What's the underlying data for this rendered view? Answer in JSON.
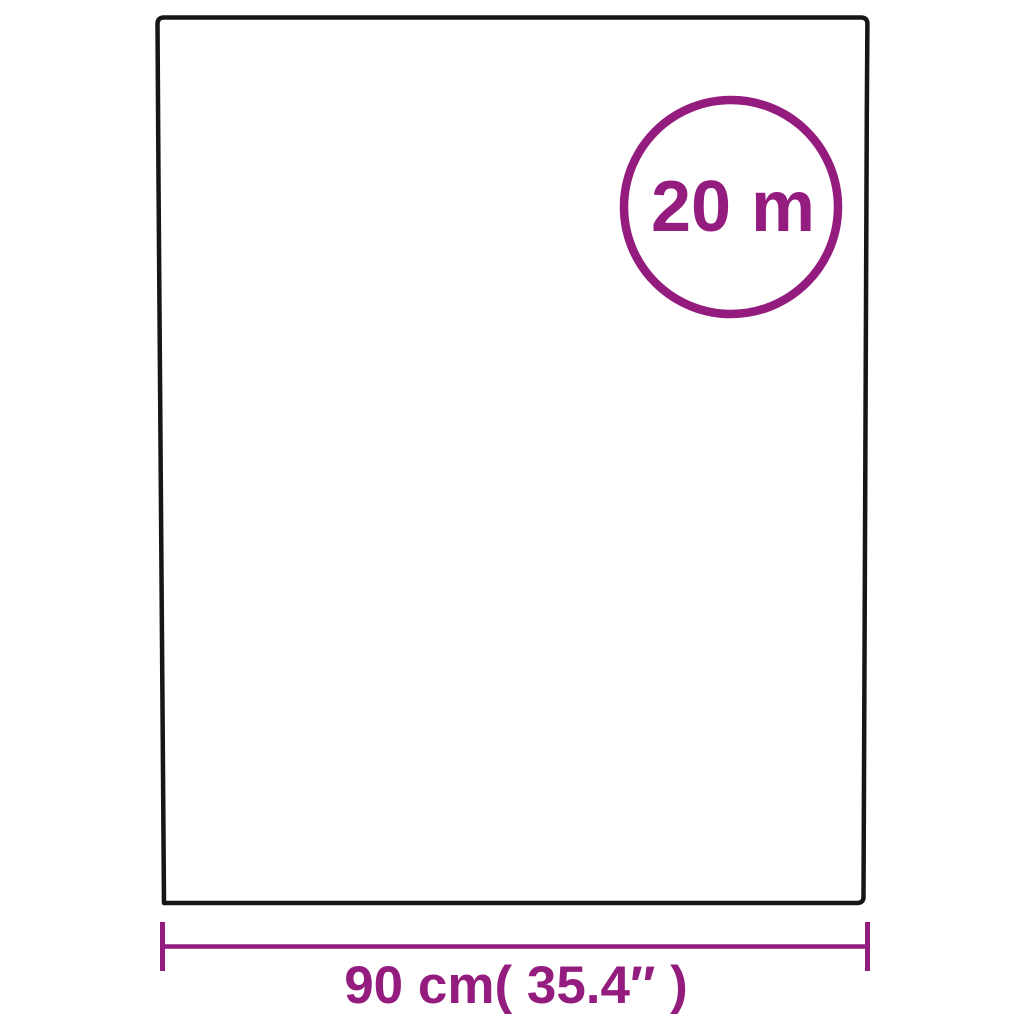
{
  "page": {
    "background_color": "#ffffff",
    "description_labels": {
      "length_badge": "20 m",
      "width_dimension": "90 cm( 35.4″ )"
    }
  },
  "diagram": {
    "product_outline": {
      "color": "#161616"
    },
    "length_badge": {
      "label": "20 m",
      "color": "#941c7e"
    },
    "width_dimension": {
      "label": "90 cm( 35.4″ )",
      "color": "#941c7e"
    }
  }
}
